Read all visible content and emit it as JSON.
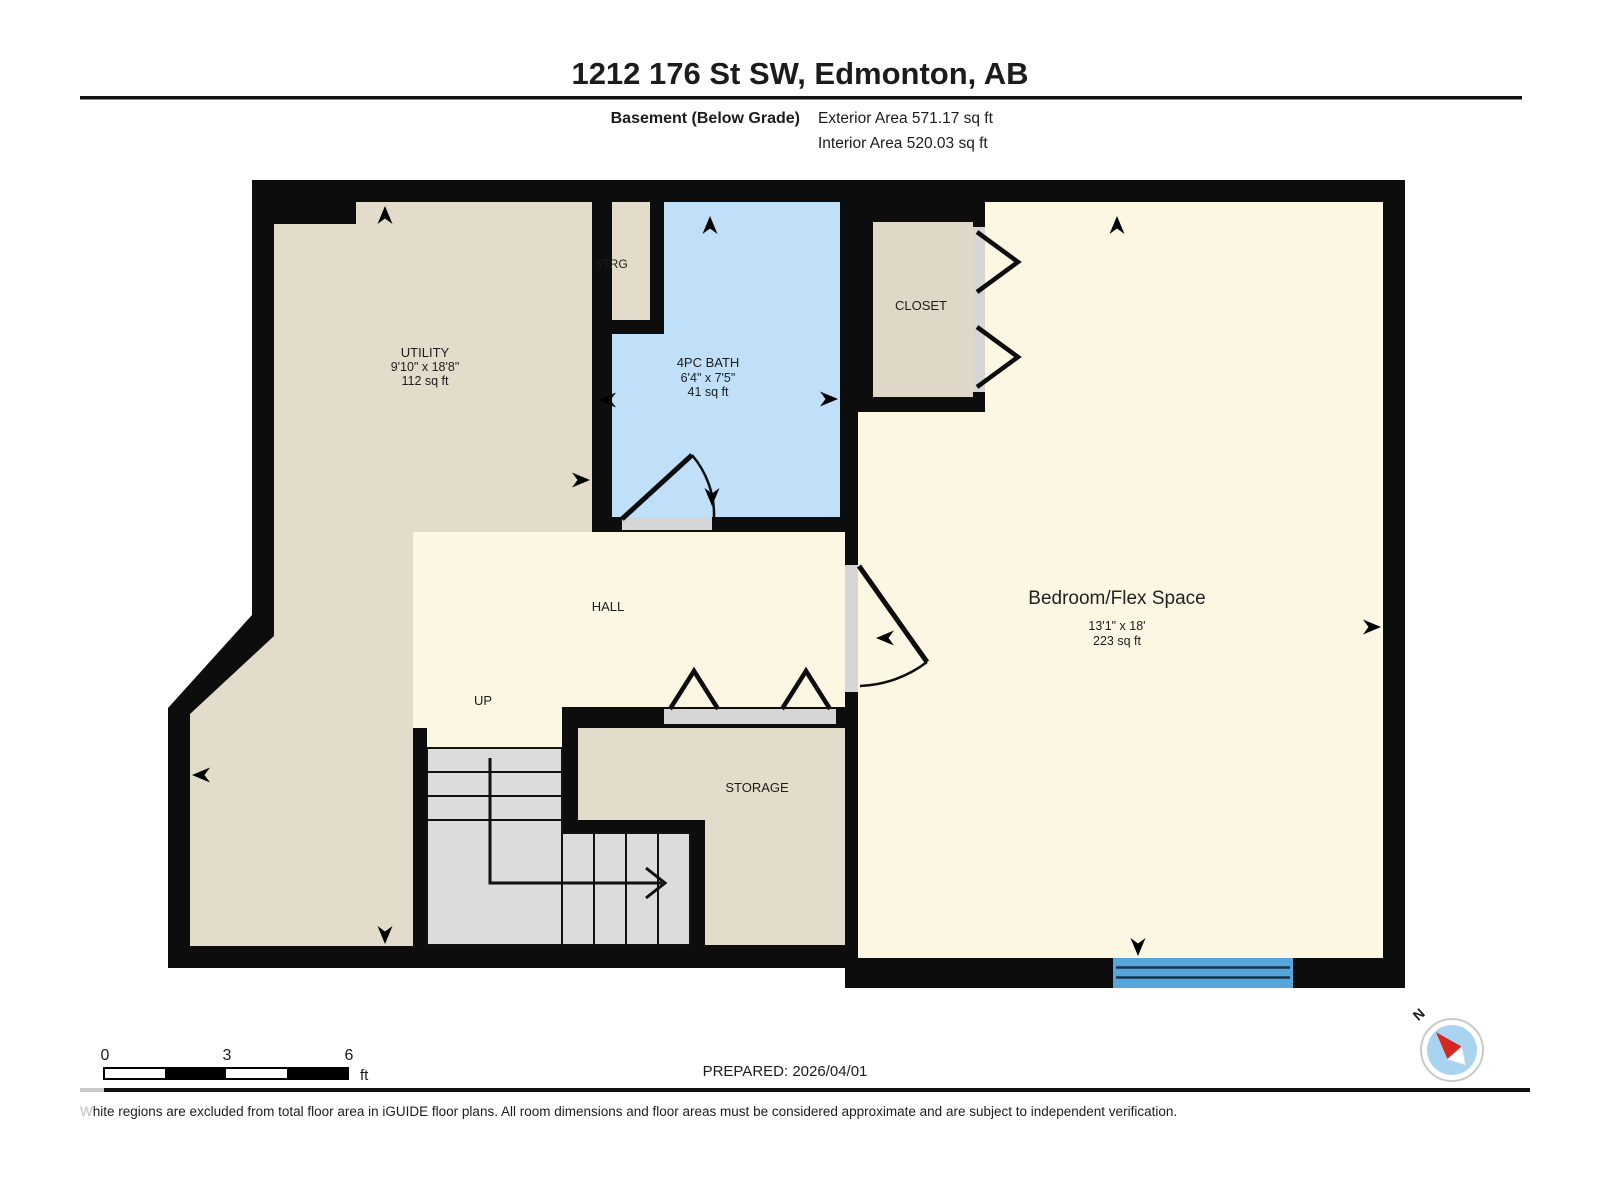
{
  "header": {
    "title": "1212 176 St SW, Edmonton, AB",
    "floor_label": "Basement (Below Grade)",
    "exterior_area": "Exterior Area 571.17 sq ft",
    "interior_area": "Interior Area 520.03 sq ft"
  },
  "rooms": {
    "utility": {
      "name": "UTILITY",
      "dimensions": "9'10\" x 18'8\"",
      "area": "112 sq ft"
    },
    "strg": {
      "name": "STRG"
    },
    "bath": {
      "name": "4PC BATH",
      "dimensions": "6'4\" x 7'5\"",
      "area": "41 sq ft"
    },
    "closet": {
      "name": "CLOSET"
    },
    "hall": {
      "name": "HALL"
    },
    "stairs": {
      "name": "UP"
    },
    "storage": {
      "name": "STORAGE"
    },
    "bedroom": {
      "name": "Bedroom/Flex Space",
      "dimensions": "13'1\" x 18'",
      "area": "223 sq ft"
    }
  },
  "scale_bar": {
    "ticks": [
      "0",
      "3",
      "6"
    ],
    "unit": "ft"
  },
  "compass": {
    "north": "N"
  },
  "footer": {
    "prepared": "PREPARED: 2026/04/01",
    "disclaimer_lead": "W",
    "disclaimer_rest": "hite regions are excluded from total floor area in iGUIDE floor plans. All room dimensions and floor areas must be considered approximate and are subject to independent verification."
  },
  "colors": {
    "wall": "#0d0d0d",
    "floor_warm": "#e4dcca",
    "floor_cream": "#fcf7e2",
    "floor_bath": "#bfe0f8",
    "stairs": "#dcdcdc",
    "door_jamb": "#d6d6d6",
    "window": "#55a6da",
    "compass_blue": "#a9d4f1",
    "compass_red": "#d62621"
  }
}
